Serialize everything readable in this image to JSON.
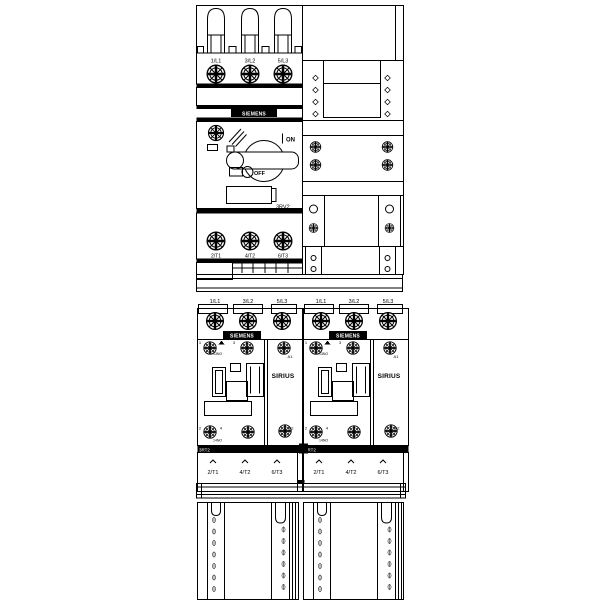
{
  "colors": {
    "line": "#000000",
    "background": "#ffffff"
  },
  "branding": {
    "manufacturer": "SIEMENS"
  },
  "breaker": {
    "model": "3RV2",
    "on_label": "ON",
    "off_label": "OFF",
    "line_terminals": [
      "1/L1",
      "3/L2",
      "5/L3"
    ],
    "load_terminals": [
      "2/T1",
      "4/T2",
      "6/T3"
    ]
  },
  "contactors": [
    {
      "brand": "SIEMENS",
      "series": "SIRIUS",
      "model": "3RT2",
      "line_terminals": [
        "1/L1",
        "3/L2",
        "5/L3"
      ],
      "load_terminals": [
        "2/T1",
        "4/T2",
        "6/T3"
      ],
      "coil_terminal_top": "A1",
      "coil_terminal_bottom": "A2",
      "aux_terminal_top": "13NO",
      "aux_terminal_bottom": "14NO",
      "pole_marks_top": [
        "1",
        "3"
      ],
      "pole_marks_bottom": [
        "2",
        "4"
      ]
    },
    {
      "brand": "SIEMENS",
      "series": "SIRIUS",
      "model": "3RT2",
      "line_terminals": [
        "1/L1",
        "3/L2",
        "5/L3"
      ],
      "load_terminals": [
        "2/T1",
        "4/T2",
        "6/T3"
      ],
      "coil_terminal_top": "A1",
      "coil_terminal_bottom": "A2",
      "aux_terminal_top": "13NO",
      "aux_terminal_bottom": "14NO",
      "pole_marks_top": [
        "1",
        "3"
      ],
      "pole_marks_bottom": [
        "2",
        "4"
      ]
    }
  ]
}
